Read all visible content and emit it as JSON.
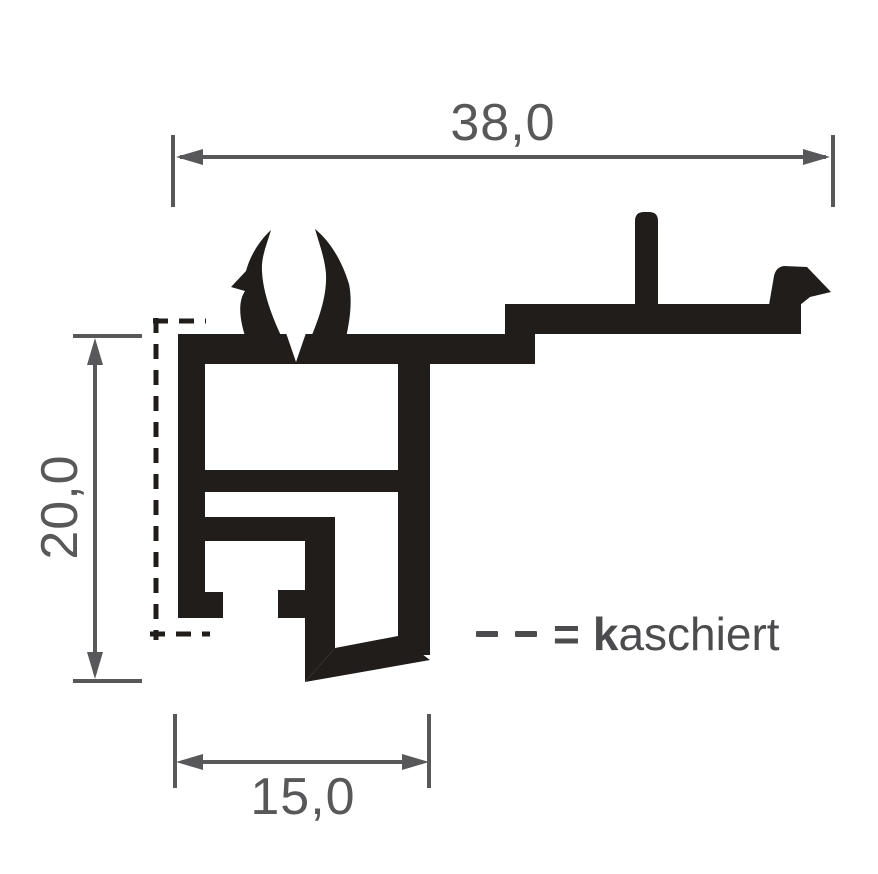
{
  "drawing": {
    "dimensions": {
      "top_width": "38,0",
      "left_height": "20,0",
      "bottom_width": "15,0"
    },
    "legend": {
      "equals_sign": "=",
      "label_bold_prefix": "k",
      "label_rest": "aschiert"
    },
    "colors": {
      "background": "#ffffff",
      "profile": "#201d1b",
      "dimension": "#58585a",
      "legend": "#4c4c4e"
    }
  }
}
